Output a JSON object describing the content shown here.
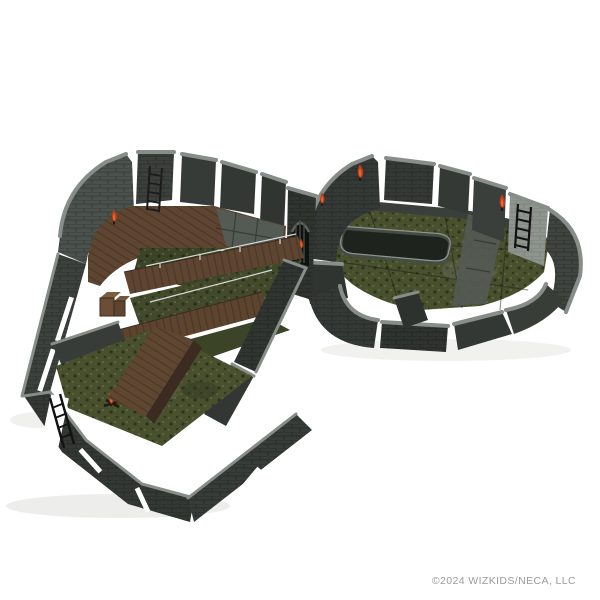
{
  "photo": {
    "subject": "Modular dungeon terrain miniature set with dark stone brick walls, mossy stone floors, wooden walkways and bridges, a wooden ramp with crates, black ladders, red wall torches, an arched portcullis doorway, a railed stair pit and a campfire, photographed on a white background",
    "copyright": "©2024 WIZKIDS/NECA, LLC"
  },
  "palette": {
    "bg": "#ffffff",
    "wall": "#343936",
    "wallOuter": "#4b514c",
    "wallLight": "#878d88",
    "wallFace": "#8e948e",
    "moss": "#49502e",
    "mossDark": "#3c4427",
    "pit": "#1e231d",
    "stone": "#545a54",
    "wood": "#5d4531",
    "woodDark": "#3b2b20",
    "woodLight": "#7b5c3e",
    "torch": "#c23a17",
    "torchGlow": "#e06a33",
    "ladder": "#121212",
    "railing": "#d5d8d4",
    "shadow": "#ededec",
    "copyright": "#9b9b9b"
  }
}
